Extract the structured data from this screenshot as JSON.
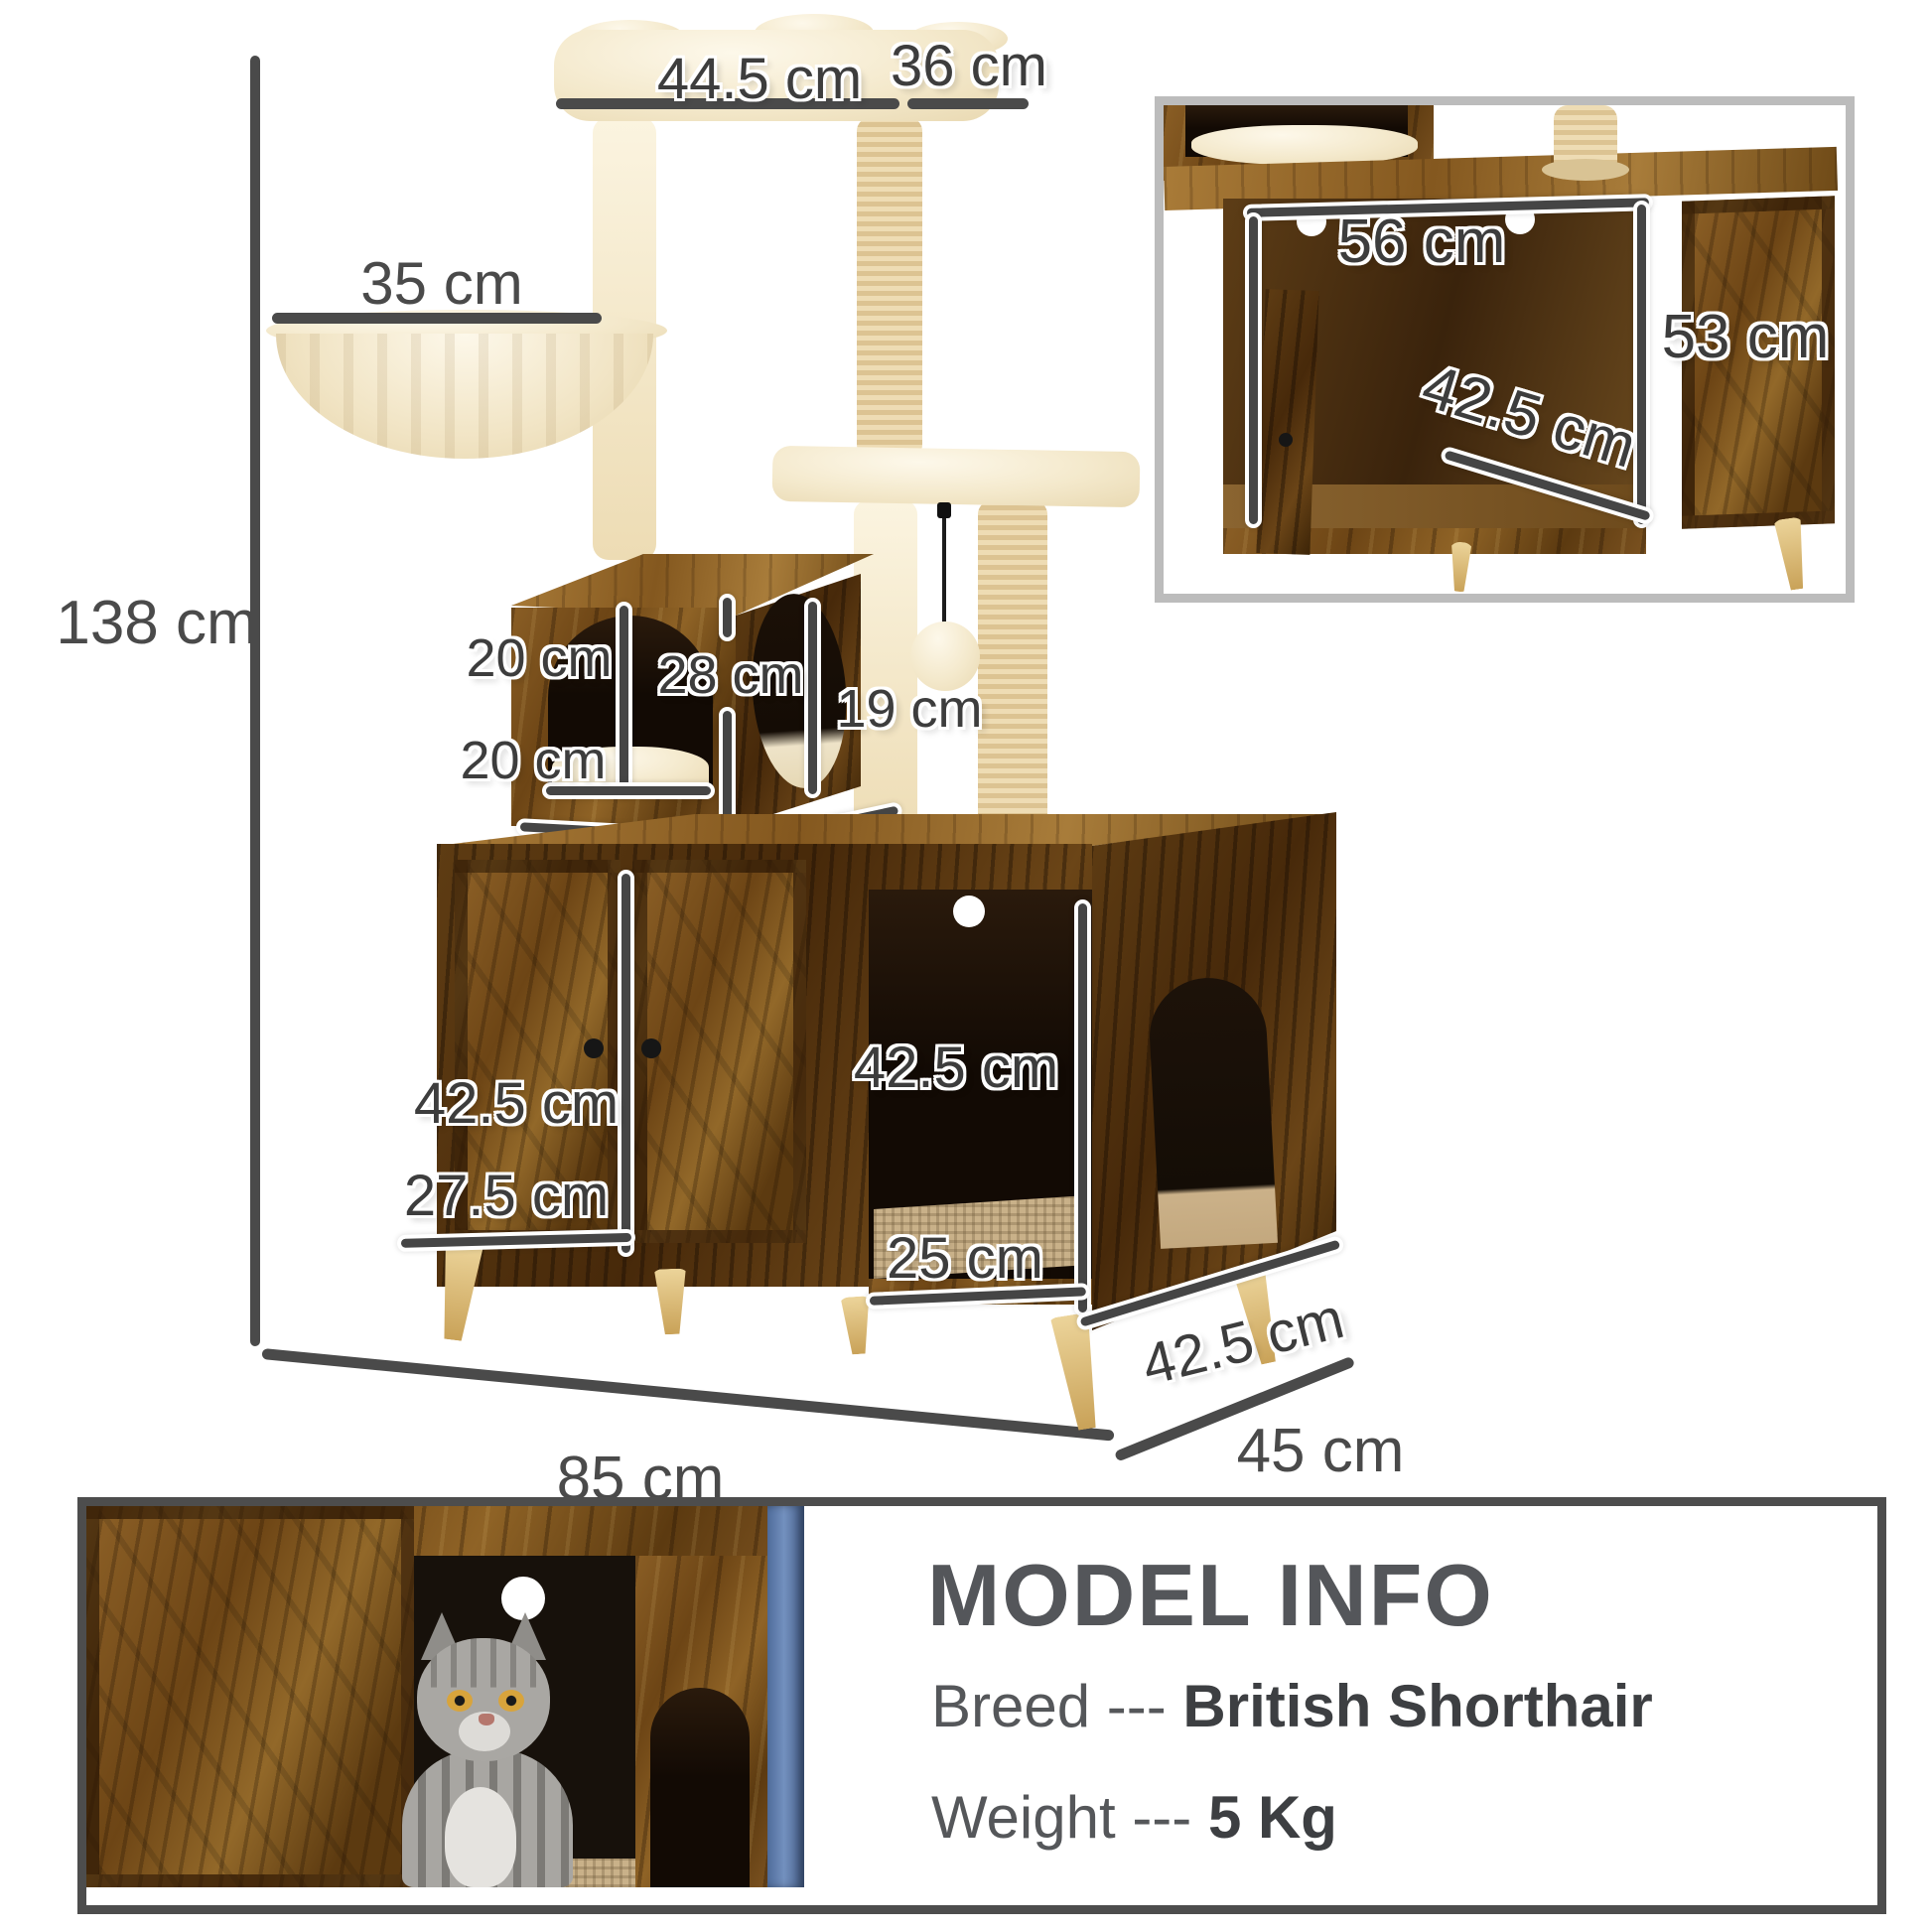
{
  "main_diagram": {
    "total_height": "138 cm",
    "top_platform_width": "44.5 cm",
    "top_platform_depth": "36 cm",
    "hammock_diameter": "35 cm",
    "house_opening_top": "20 cm",
    "house_opening_height": "28 cm",
    "house_side_opening": "19 cm",
    "house_opening_bottom": "20 cm",
    "house_width": "30 cm",
    "house_depth": "30 cm",
    "door_height": "42.5 cm",
    "door_width": "27.5 cm",
    "compartment_height": "42.5 cm",
    "compartment_width": "25 cm",
    "base_depth_edge": "42.5 cm",
    "base_width": "85 cm",
    "base_depth": "45 cm"
  },
  "inset_diagram": {
    "interior_width": "56 cm",
    "interior_height": "53 cm",
    "interior_depth": "42.5 cm"
  },
  "model_info": {
    "title": "MODEL INFO",
    "breed_label": "Breed ---",
    "breed_value": "British Shorthair",
    "weight_label": "Weight ---",
    "weight_value": "5 Kg"
  },
  "colors": {
    "dimension_line": "#4a4a4a",
    "label_text": "#3d3d3d",
    "wood_brown": "#7b5220",
    "wood_dark": "#47290a",
    "plush_beige": "#f4e9cc",
    "sisal_tan": "#e3cd9e",
    "inset_border": "#bcbcbc",
    "panel_border": "#4d4d4d",
    "curtain_blue": "#4f6c9b"
  }
}
